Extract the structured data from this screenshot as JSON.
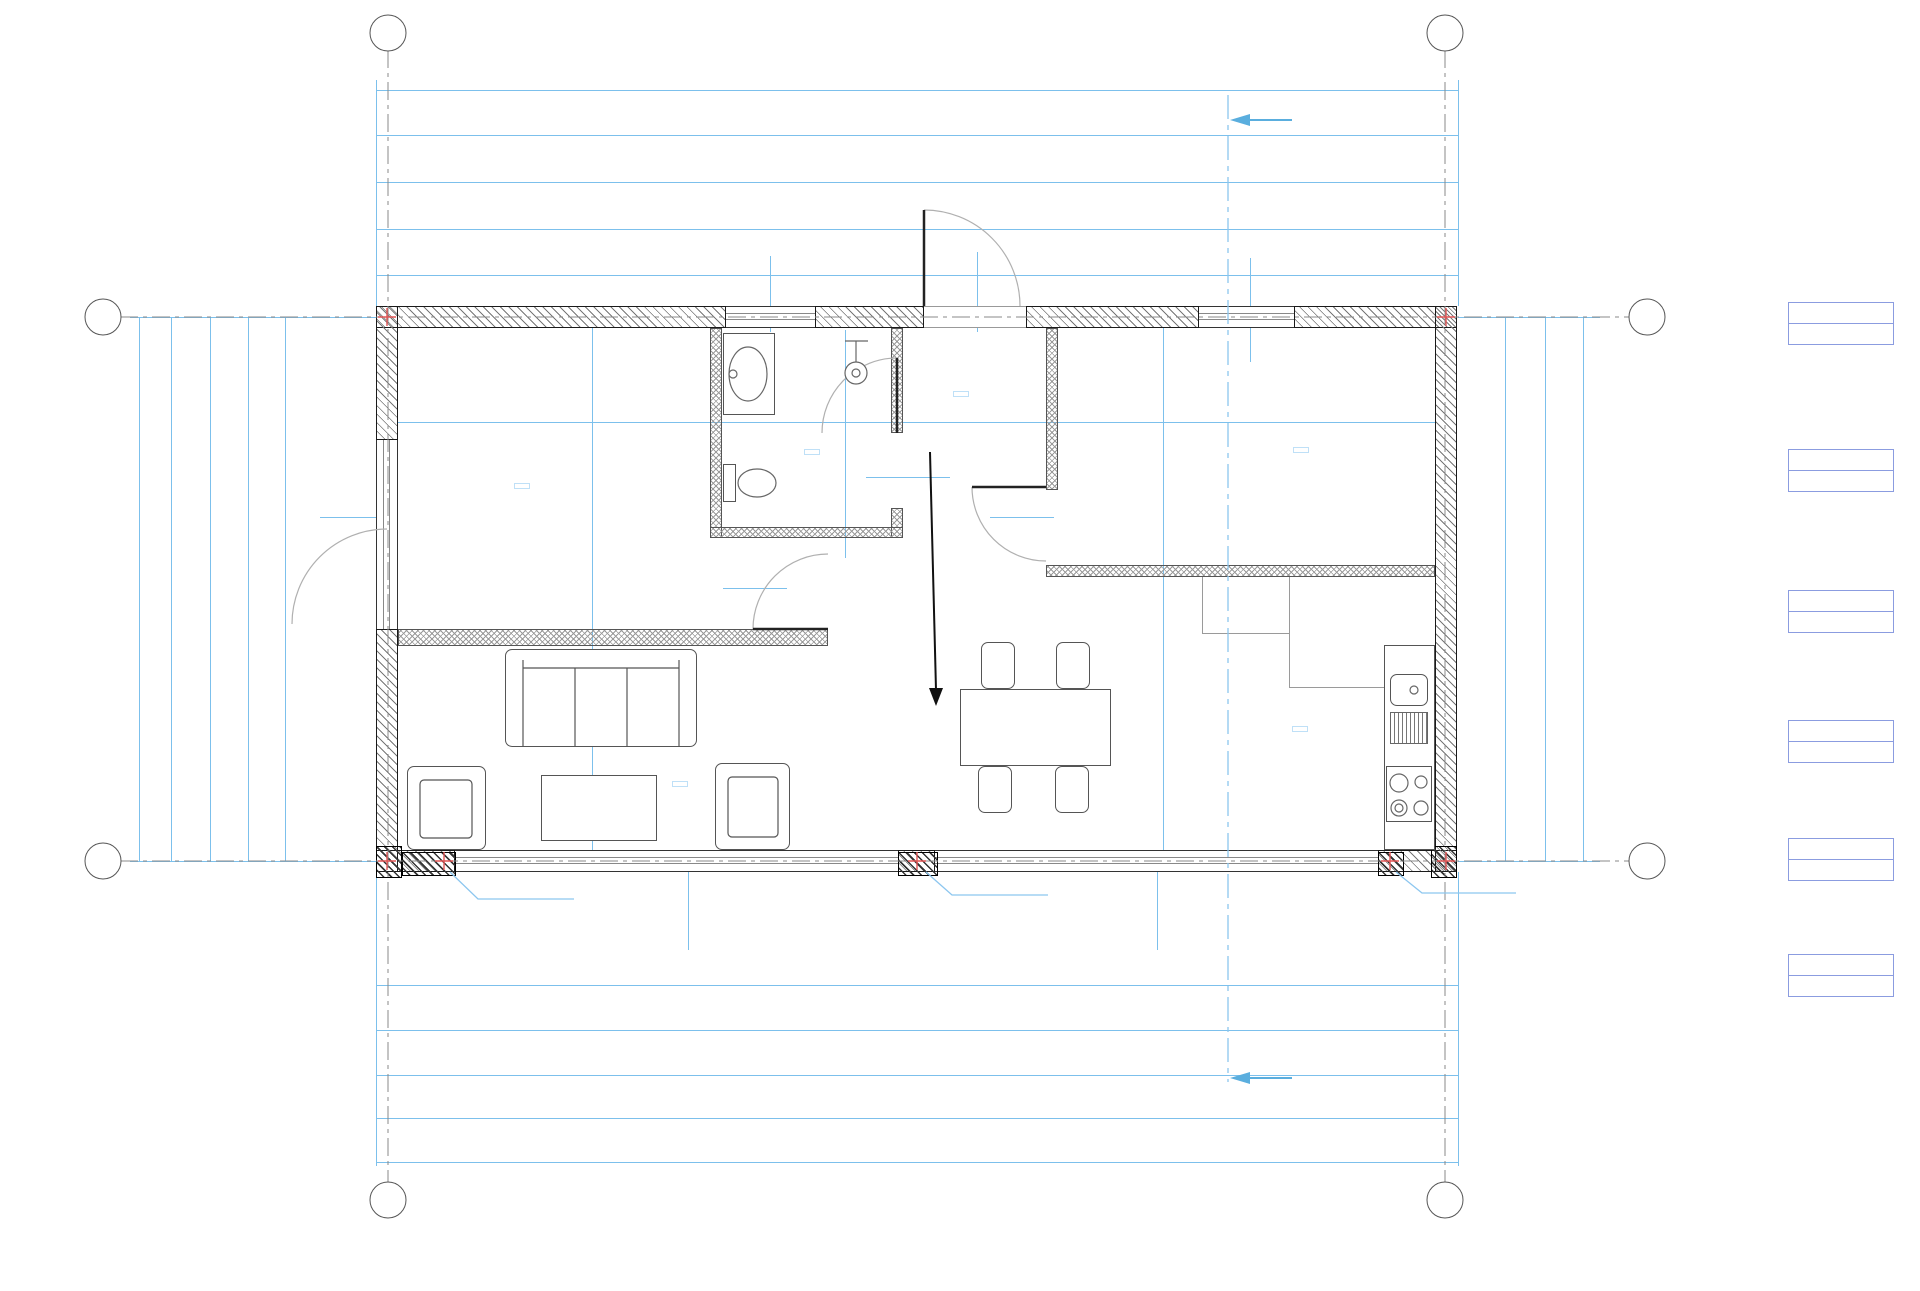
{
  "title": "rzut parteru",
  "axes": {
    "a": "A",
    "b": "B",
    "n1": "1",
    "n2": "2"
  },
  "section": {
    "label": "A-01"
  },
  "watermark": {
    "line1": "www.zbudujsamdom.pl",
    "line2": "PODGLĄD"
  },
  "rooms": {
    "r1": "01",
    "r2": "02",
    "r3": "03",
    "r4": "04",
    "r5": "05",
    "r6": "06"
  },
  "rdz": {
    "left": "Rdz.2",
    "mid": "Rdz.3",
    "right": "Rdz.2"
  },
  "legend": {
    "items": [
      {
        "name": "pokój 1",
        "number": "01",
        "area": "A: 10,3 m²"
      },
      {
        "name": "salon",
        "number": "02",
        "area": "A: 19,4 m²"
      },
      {
        "name": "łazienka",
        "number": "03",
        "area": "A: 3,7 m²"
      },
      {
        "name": "wejscie",
        "number": "04",
        "area": "A: 3,3 m²"
      },
      {
        "name": "pokój 2",
        "number": "04",
        "area": "A: 10,2 m²"
      },
      {
        "name": "kuchnia",
        "number": "06",
        "area": "A: 11,9 m²"
      }
    ]
  },
  "colors": {
    "dim_text": "#2021d4",
    "dim_line": "#7cc0ec",
    "watermark": "rgba(125,188,236,0.55)",
    "marker_red": "#e25555"
  },
  "dim_labels": [
    {
      "t": "1 147",
      "x": 917,
      "y": 80
    },
    {
      "t": "24",
      "x": 387,
      "y": 125
    },
    {
      "t": "330",
      "x": 554,
      "y": 125
    },
    {
      "t": "13",
      "x": 716,
      "y": 125
    },
    {
      "t": "179",
      "x": 806,
      "y": 125
    },
    {
      "t": "13",
      "x": 897,
      "y": 125
    },
    {
      "t": "153",
      "x": 975,
      "y": 125
    },
    {
      "t": "13",
      "x": 1053,
      "y": 125
    },
    {
      "t": "400",
      "x": 1248,
      "y": 125
    },
    {
      "t": "24",
      "x": 1448,
      "y": 125
    },
    {
      "t": "371",
      "x": 551,
      "y": 172
    },
    {
      "t": "95",
      "x": 771,
      "y": 172
    },
    {
      "t": "115",
      "x": 869,
      "y": 172
    },
    {
      "t": "108",
      "x": 975,
      "y": 172
    },
    {
      "t": "184",
      "x": 1113,
      "y": 172
    },
    {
      "t": "100",
      "x": 1246,
      "y": 172
    },
    {
      "t": "174",
      "x": 1376,
      "y": 172
    },
    {
      "t": "418",
      "x": 573,
      "y": 219
    },
    {
      "t": "217",
      "x": 872,
      "y": 219
    },
    {
      "t": "288",
      "x": 1111,
      "y": 219
    },
    {
      "t": "225",
      "x": 1353,
      "y": 219
    },
    {
      "t": "12",
      "x": 382,
      "y": 265
    },
    {
      "t": "569",
      "x": 656,
      "y": 265
    },
    {
      "t": "554",
      "x": 1185,
      "y": 265
    },
    {
      "t": "12",
      "x": 1452,
      "y": 265
    },
    {
      "t": "12",
      "x": 382,
      "y": 975
    },
    {
      "t": "1 123",
      "x": 917,
      "y": 975
    },
    {
      "t": "12",
      "x": 1452,
      "y": 975
    },
    {
      "t": "320",
      "x": 527,
      "y": 1020
    },
    {
      "t": "509",
      "x": 918,
      "y": 1020
    },
    {
      "t": "318",
      "x": 1308,
      "y": 1020
    },
    {
      "t": "84",
      "x": 416,
      "y": 1065
    },
    {
      "t": "470",
      "x": 677,
      "y": 1065
    },
    {
      "t": "39",
      "x": 917,
      "y": 1065
    },
    {
      "t": "470",
      "x": 1157,
      "y": 1065
    },
    {
      "t": "84",
      "x": 1418,
      "y": 1065
    },
    {
      "t": "24",
      "x": 387,
      "y": 1108
    },
    {
      "t": "1 099",
      "x": 917,
      "y": 1108
    },
    {
      "t": "24",
      "x": 1446,
      "y": 1108
    },
    {
      "t": "1 147",
      "x": 917,
      "y": 1152
    },
    {
      "t": "600",
      "x": 139,
      "y": 590,
      "v": 1
    },
    {
      "t": "24",
      "x": 171,
      "y": 330,
      "v": 1
    },
    {
      "t": "312",
      "x": 171,
      "y": 478,
      "v": 1
    },
    {
      "t": "13",
      "x": 171,
      "y": 645,
      "v": 1
    },
    {
      "t": "228",
      "x": 171,
      "y": 752,
      "v": 1
    },
    {
      "t": "24",
      "x": 171,
      "y": 845,
      "v": 1
    },
    {
      "t": "119",
      "x": 210,
      "y": 365,
      "v": 1
    },
    {
      "t": "200",
      "x": 210,
      "y": 513,
      "v": 1
    },
    {
      "t": "282",
      "x": 210,
      "y": 742,
      "v": 1
    },
    {
      "t": "219",
      "x": 248,
      "y": 412,
      "v": 1
    },
    {
      "t": "381",
      "x": 248,
      "y": 693,
      "v": 1
    },
    {
      "t": "12",
      "x": 285,
      "y": 330,
      "v": 1
    },
    {
      "t": "576",
      "x": 285,
      "y": 593,
      "v": 1
    },
    {
      "t": "12",
      "x": 285,
      "y": 852,
      "v": 1
    },
    {
      "t": "12",
      "x": 1505,
      "y": 328,
      "v": 1
    },
    {
      "t": "576",
      "x": 1505,
      "y": 590,
      "v": 1
    },
    {
      "t": "12",
      "x": 1505,
      "y": 850,
      "v": 1
    },
    {
      "t": "24",
      "x": 1545,
      "y": 332,
      "v": 1
    },
    {
      "t": "254",
      "x": 1545,
      "y": 430,
      "v": 1
    },
    {
      "t": "13",
      "x": 1545,
      "y": 552,
      "v": 1
    },
    {
      "t": "286",
      "x": 1545,
      "y": 668,
      "v": 1
    },
    {
      "t": "24",
      "x": 1545,
      "y": 848,
      "v": 1
    },
    {
      "t": "600",
      "x": 1583,
      "y": 590,
      "v": 1
    },
    {
      "t": "330",
      "x": 554,
      "y": 413
    },
    {
      "t": "13",
      "x": 728,
      "y": 413
    },
    {
      "t": "179",
      "x": 806,
      "y": 413
    },
    {
      "t": "13",
      "x": 908,
      "y": 413
    },
    {
      "t": "153",
      "x": 975,
      "y": 413
    },
    {
      "t": "13",
      "x": 1065,
      "y": 413
    },
    {
      "t": "400",
      "x": 1248,
      "y": 413
    },
    {
      "t": "24",
      "x": 586,
      "y": 324,
      "v": 1
    },
    {
      "t": "267",
      "x": 586,
      "y": 455,
      "v": 1
    },
    {
      "t": "45",
      "x": 586,
      "y": 607,
      "v": 1
    },
    {
      "t": "13",
      "x": 586,
      "y": 652,
      "v": 1
    },
    {
      "t": "228",
      "x": 586,
      "y": 763,
      "v": 1
    },
    {
      "t": "24",
      "x": 1166,
      "y": 316,
      "v": 1
    },
    {
      "t": "204",
      "x": 1155,
      "y": 430,
      "v": 1
    },
    {
      "t": "51",
      "x": 1155,
      "y": 551,
      "v": 1
    },
    {
      "t": "13",
      "x": 1155,
      "y": 594,
      "v": 1
    },
    {
      "t": "286",
      "x": 1155,
      "y": 716,
      "v": 1
    },
    {
      "t": "152",
      "x": 838,
      "y": 400,
      "v": 1
    },
    {
      "t": "54",
      "x": 838,
      "y": 500,
      "v": 1
    },
    {
      "t": "13",
      "x": 838,
      "y": 549,
      "v": 1
    },
    {
      "t": "200",
      "x": 358,
      "y": 506
    },
    {
      "t": "210",
      "x": 358,
      "y": 528
    },
    {
      "t": "95",
      "x": 758,
      "y": 284,
      "v": 1
    },
    {
      "t": "60",
      "x": 781,
      "y": 284,
      "v": 1
    },
    {
      "t": "100",
      "x": 965,
      "y": 284,
      "v": 1
    },
    {
      "t": "210",
      "x": 986,
      "y": 284,
      "v": 1
    },
    {
      "t": "100",
      "x": 1240,
      "y": 289,
      "v": 1
    },
    {
      "t": "210",
      "x": 1261,
      "y": 289,
      "v": 1
    },
    {
      "t": "80",
      "x": 755,
      "y": 577
    },
    {
      "t": "210",
      "x": 755,
      "y": 598
    },
    {
      "t": "80",
      "x": 926,
      "y": 464
    },
    {
      "t": "205",
      "x": 926,
      "y": 487
    },
    {
      "t": "80",
      "x": 1022,
      "y": 504
    },
    {
      "t": "210",
      "x": 1022,
      "y": 530
    },
    {
      "t": "470",
      "x": 678,
      "y": 914,
      "v": 1
    },
    {
      "t": "220",
      "x": 700,
      "y": 914,
      "v": 1
    },
    {
      "t": "470",
      "x": 1147,
      "y": 914,
      "v": 1
    },
    {
      "t": "220",
      "x": 1169,
      "y": 914,
      "v": 1
    },
    {
      "t": "hp 0",
      "x": 676,
      "y": 844,
      "k": 1
    },
    {
      "t": "hp 1",
      "x": 1150,
      "y": 844,
      "k": 1
    },
    {
      "t": "hp 10",
      "x": 1250,
      "y": 349,
      "k": 1
    },
    {
      "t": "54",
      "x": 774,
      "y": 343,
      "k": 1
    }
  ]
}
